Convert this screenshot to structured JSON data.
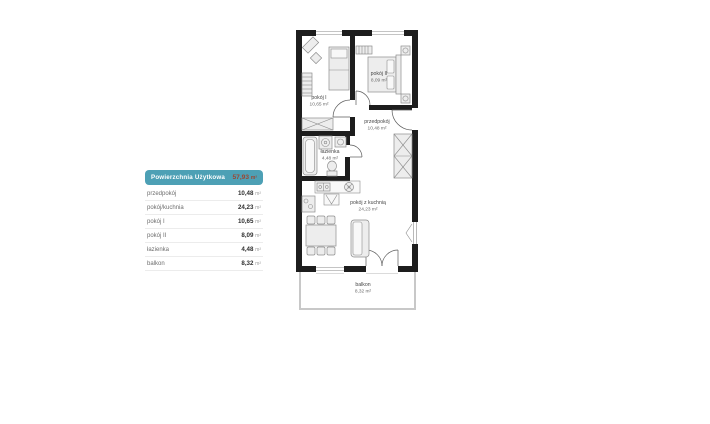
{
  "colors": {
    "accent_teal": "#4da0b5",
    "accent_value": "#9c4632",
    "wall": "#1d1d1d"
  },
  "legend": {
    "header": {
      "title": "Powierzchnia Użytkowa",
      "value": "57,93",
      "unit": "m²"
    },
    "rows": [
      {
        "label": "przedpokój",
        "value": "10,48",
        "unit": "m²"
      },
      {
        "label": "pokój/kuchnia",
        "value": "24,23",
        "unit": "m²"
      },
      {
        "label": "pokój I",
        "value": "10,65",
        "unit": "m²"
      },
      {
        "label": "pokój II",
        "value": "8,09",
        "unit": "m²"
      },
      {
        "label": "łazienka",
        "value": "4,48",
        "unit": "m²"
      },
      {
        "label": "balkon",
        "value": "8,32",
        "unit": "m²"
      }
    ]
  },
  "plan": {
    "rooms": [
      {
        "name": "pokój I",
        "area": "10,65 m²"
      },
      {
        "name": "pokój II",
        "area": "8,09 m²"
      },
      {
        "name": "przedpokój",
        "area": "10,48 m²"
      },
      {
        "name": "łazienka",
        "area": "4,48 m²"
      },
      {
        "name": "pokój z kuchnią",
        "area": "24,23 m²"
      },
      {
        "name": "balkon",
        "area": "8,32 m²"
      }
    ]
  }
}
